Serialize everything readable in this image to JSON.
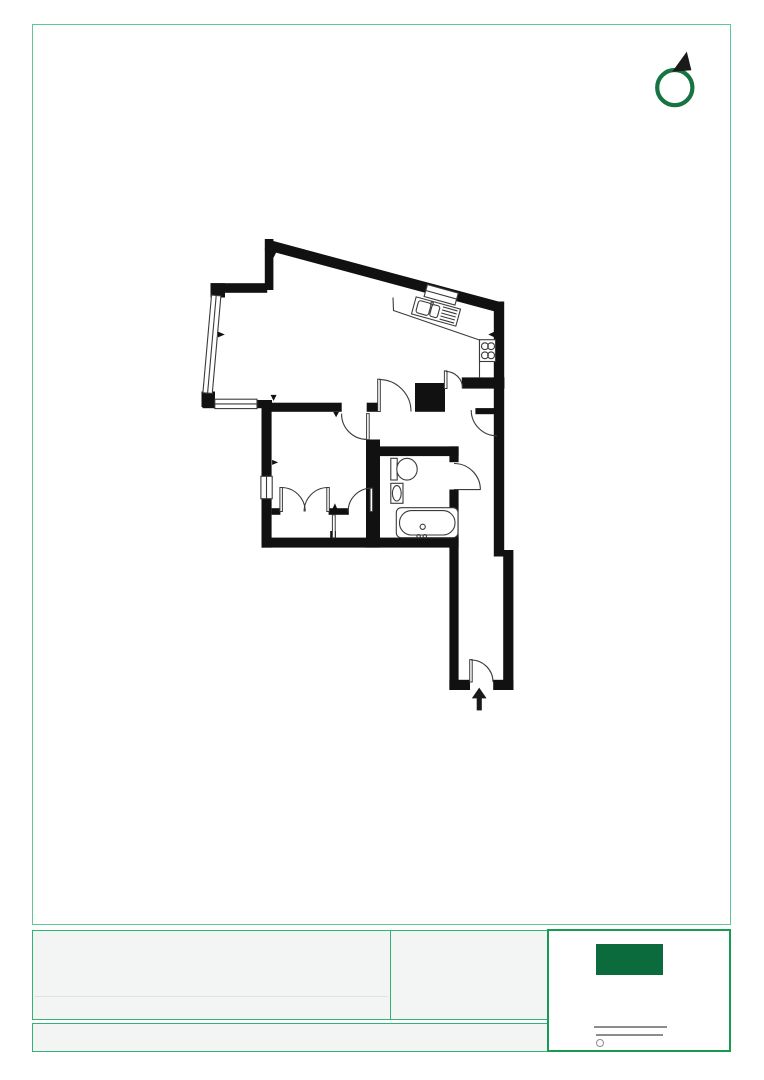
{
  "document": {
    "kind": "floor-plan-page",
    "visible_text": ""
  },
  "colors": {
    "paper": "#ffffff",
    "frame": "#5ec795",
    "wall": "#111111",
    "line": "#3a3a3a",
    "footer-border": "#30b377",
    "footer-fill": "#f3f5f4",
    "faint-line": "#dfe3e0",
    "logo-border": "#189a53",
    "logo-fill": "#0b6b3c",
    "compass": "#177442",
    "gray-line": "#8c8c8c",
    "arrow": "#1a1a1a"
  },
  "compass": {
    "icon": "north-arrow-icon"
  },
  "floorplan": {
    "features": [
      "exterior-walls",
      "angled-kitchen-wall",
      "window-left",
      "window-bottom",
      "window-bedroom",
      "kitchen-window",
      "kitchen-counter",
      "kitchen-sink",
      "hob",
      "storage-block",
      "living-room-door",
      "bedroom-door",
      "kitchen-door",
      "hall-door",
      "bathroom-door",
      "wardrobe-double-door",
      "wardrobe-single-door",
      "toilet",
      "basin",
      "bathtub",
      "entrance-door",
      "entrance-arrow"
    ]
  },
  "footer": {
    "cells": [
      "details-cell-left",
      "details-cell-middle",
      "details-strip"
    ],
    "title_block": {
      "logo": "agency-logo",
      "rule_lines": 2,
      "seal": "small-circle"
    }
  }
}
